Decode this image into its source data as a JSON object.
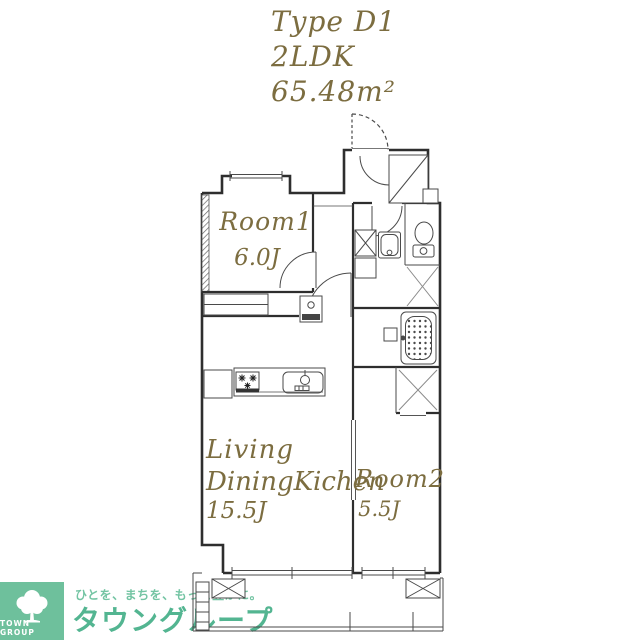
{
  "header": {
    "type_label": "Type D1",
    "layout_label": "2LDK",
    "area_label": "65.48m²"
  },
  "floor_plan": {
    "room1": {
      "name": "Room1",
      "size": "6.0J"
    },
    "ldk": {
      "line1": "Living",
      "line2": "DiningKichen",
      "size": "15.5J"
    },
    "room2": {
      "name": "Room2",
      "size": "5.5J"
    }
  },
  "footer": {
    "logo_text": "TOWN GROUP",
    "tagline": "ひとを、まちを、もっと豊かに。",
    "brand_name": "タウングループ"
  },
  "colors": {
    "label_olive": "#7c6d40",
    "wall_line": "#2e2e2e",
    "brand_green": "#53b591",
    "tagline_green": "#73c4a3",
    "logo_bg_green": "#6ec09c"
  }
}
